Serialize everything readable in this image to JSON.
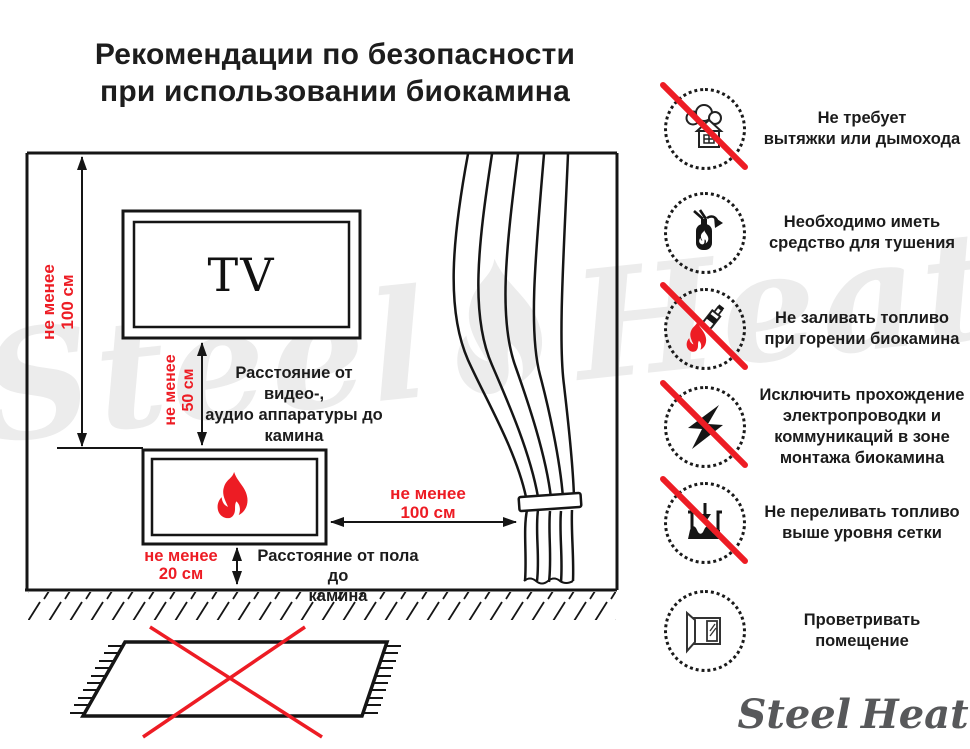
{
  "title": "Рекомендации по безопасности\nпри использовании биокамина",
  "diagram": {
    "tv_label": "TV",
    "dim_wall_label": "не менее\n100 см",
    "dim_tv_label": "не менее\n50 см",
    "dim_curtain_label": "не менее\n100 см",
    "dim_floor_label": "не менее\n20 см",
    "note_tv": "Расстояние от видео-,\nаудио аппаратуры до\nкамина",
    "note_floor": "Расстояние от пола до\nкамина"
  },
  "rules": [
    {
      "icon": "no-chimney-icon",
      "prohibited": true,
      "text": "Не требует\nвытяжки или дымохода"
    },
    {
      "icon": "extinguisher-icon",
      "prohibited": false,
      "text": "Необходимо иметь\nсредство для тушения"
    },
    {
      "icon": "no-refuel-while-burning-icon",
      "prohibited": true,
      "text": "Не заливать топливо\nпри горении биокамина"
    },
    {
      "icon": "no-electric-wiring-icon",
      "prohibited": true,
      "text": "Исключить прохождение\nэлектропроводки и\nкоммуникаций в зоне\nмонтажа биокамина"
    },
    {
      "icon": "no-overfill-icon",
      "prohibited": true,
      "text": "Не переливать топливо\nвыше уровня сетки"
    },
    {
      "icon": "ventilate-icon",
      "prohibited": false,
      "text": "Проветривать\nпомещение"
    }
  ],
  "logo": {
    "word1": "Steel",
    "word2": "Heat"
  },
  "watermark": {
    "word1": "Steel",
    "word2": "Heat"
  },
  "colors": {
    "accent_red": "#ed1c24",
    "ink": "#1a1a1a",
    "watermark": "#ececec",
    "logo_text": "#57585a"
  }
}
